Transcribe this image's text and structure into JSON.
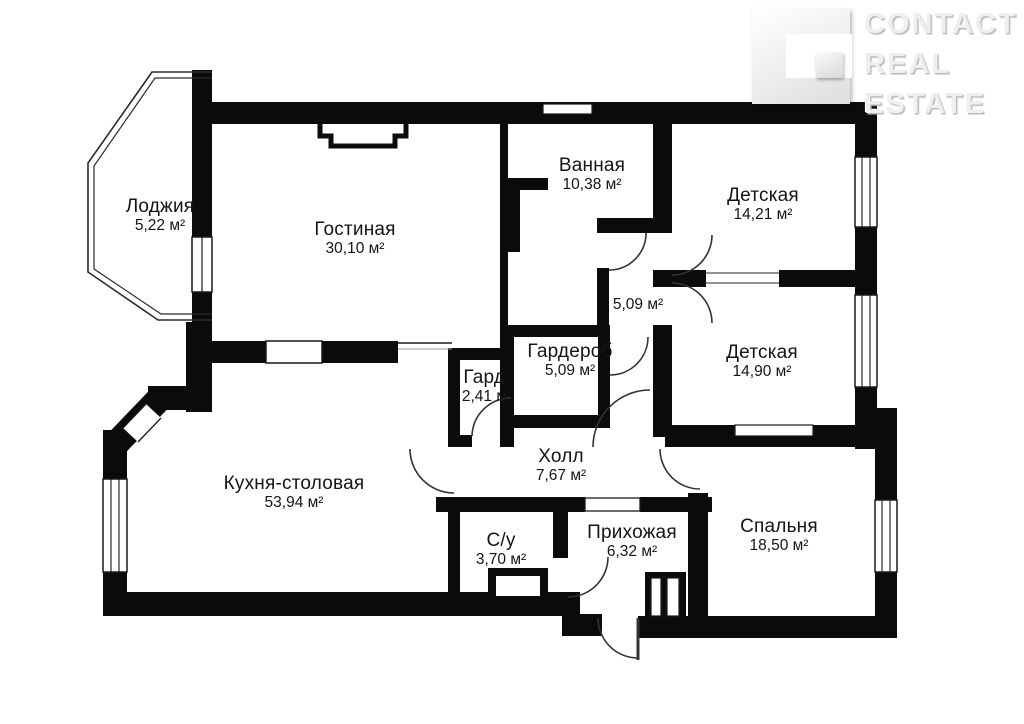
{
  "logo": {
    "lines": [
      "CONTACT",
      "REAL",
      "ESTATE"
    ]
  },
  "rooms": [
    {
      "name": "Лоджия",
      "area": "5,22 м²",
      "x": 160,
      "y": 196
    },
    {
      "name": "Гостиная",
      "area": "30,10 м²",
      "x": 355,
      "y": 219
    },
    {
      "name": "Ванная",
      "area": "10,38 м²",
      "x": 592,
      "y": 155
    },
    {
      "name": "Детская",
      "area": "14,21 м²",
      "x": 763,
      "y": 185
    },
    {
      "name": "",
      "area": "5,09 м²",
      "x": 638,
      "y": 296
    },
    {
      "name": "Гардероб",
      "area": "5,09 м²",
      "x": 570,
      "y": 341
    },
    {
      "name": "Гард.",
      "area": "2,41 м²",
      "x": 487,
      "y": 367
    },
    {
      "name": "Детская",
      "area": "14,90 м²",
      "x": 762,
      "y": 342
    },
    {
      "name": "Кухня-столовая",
      "area": "53,94 м²",
      "x": 294,
      "y": 473
    },
    {
      "name": "Холл",
      "area": "7,67 м²",
      "x": 561,
      "y": 446
    },
    {
      "name": "С/у",
      "area": "3,70 м²",
      "x": 501,
      "y": 530
    },
    {
      "name": "Прихожая",
      "area": "6,32 м²",
      "x": 632,
      "y": 522
    },
    {
      "name": "Спальня",
      "area": "18,50 м²",
      "x": 779,
      "y": 516
    }
  ]
}
